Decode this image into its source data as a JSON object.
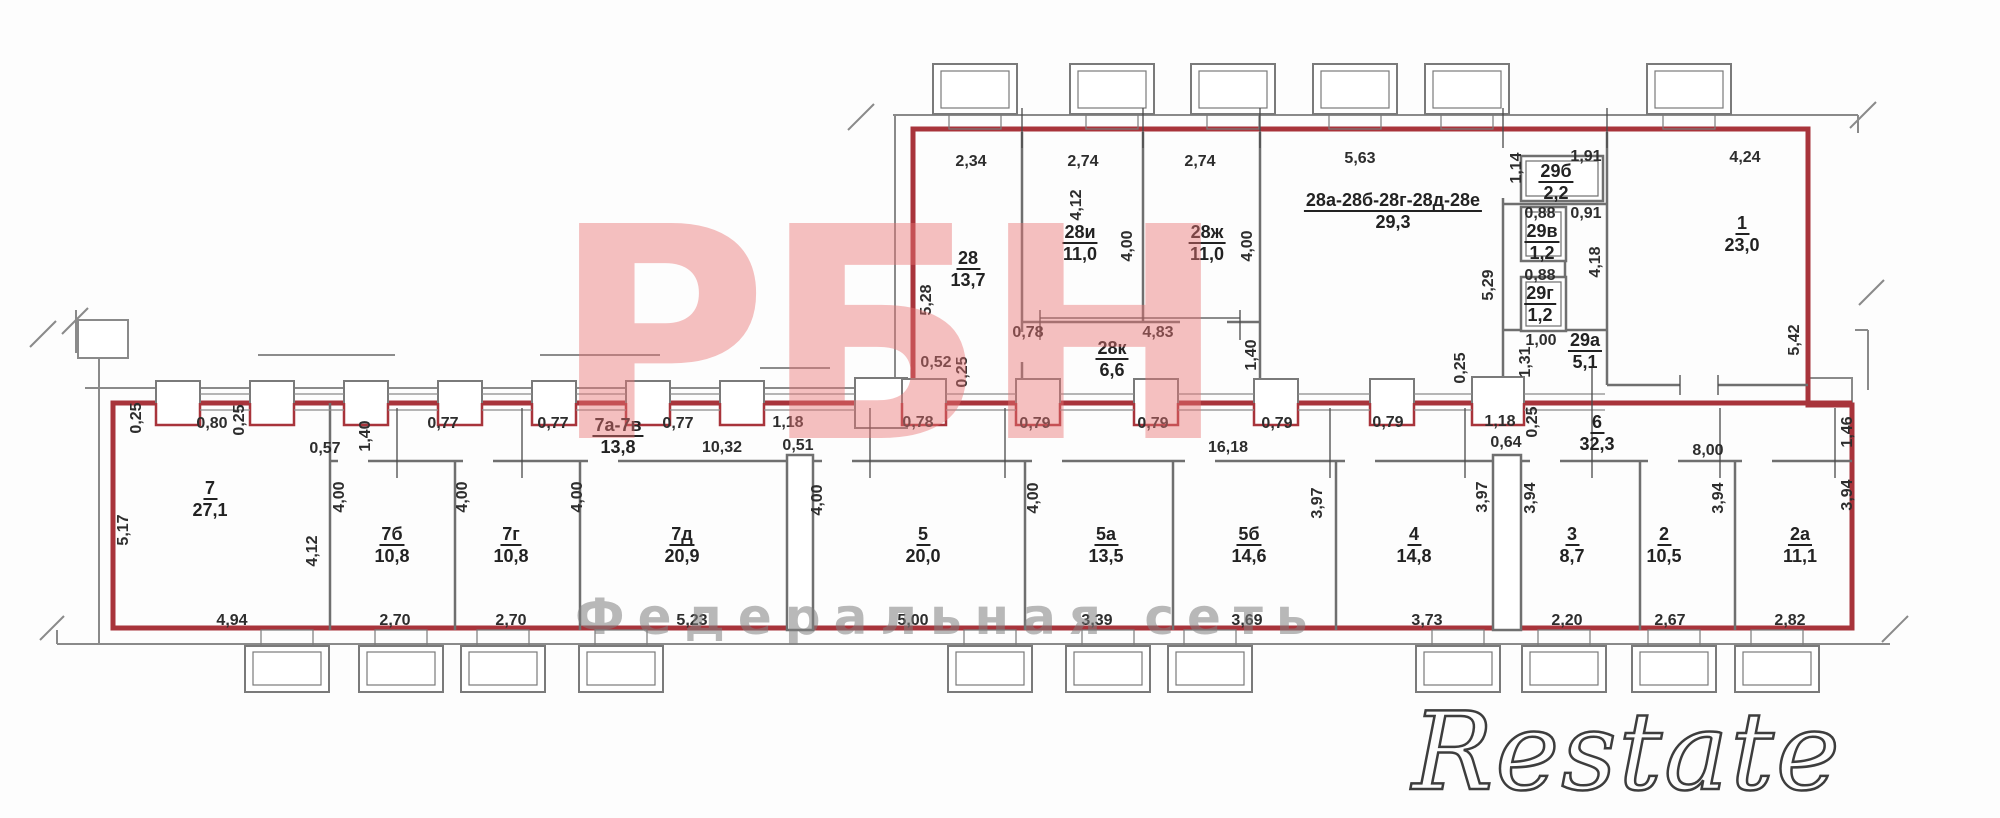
{
  "watermarks": {
    "brand": "РБН",
    "subtitle": "Федеральная сеть",
    "corner": "Restate"
  },
  "colors": {
    "boundary_red": "#A8343B",
    "wall_gray": "#8a8a8a",
    "watermark_pink": "#e97373",
    "watermark_gray": "#808080",
    "text": "#2d2d2d",
    "background": "#ffffff"
  },
  "rooms": [
    {
      "id": "28",
      "area": "13,7",
      "x": 968,
      "y": 248
    },
    {
      "id": "28и",
      "area": "11,0",
      "x": 1080,
      "y": 222
    },
    {
      "id": "28ж",
      "area": "11,0",
      "x": 1207,
      "y": 222
    },
    {
      "id": "28а-28б-28г-28д-28е",
      "area": "29,3",
      "x": 1393,
      "y": 190
    },
    {
      "id": "28к",
      "area": "6,6",
      "x": 1112,
      "y": 338
    },
    {
      "id": "29б",
      "area": "2,2",
      "x": 1556,
      "y": 161
    },
    {
      "id": "29в",
      "area": "1,2",
      "x": 1542,
      "y": 221
    },
    {
      "id": "29г",
      "area": "1,2",
      "x": 1540,
      "y": 283
    },
    {
      "id": "29а",
      "area": "5,1",
      "x": 1585,
      "y": 330
    },
    {
      "id": "1",
      "area": "23,0",
      "x": 1742,
      "y": 213
    },
    {
      "id": "7",
      "area": "27,1",
      "x": 210,
      "y": 478
    },
    {
      "id": "7а-7в",
      "area": "13,8",
      "x": 618,
      "y": 415
    },
    {
      "id": "6",
      "area": "32,3",
      "x": 1597,
      "y": 412
    },
    {
      "id": "7б",
      "area": "10,8",
      "x": 392,
      "y": 524
    },
    {
      "id": "7г",
      "area": "10,8",
      "x": 511,
      "y": 524
    },
    {
      "id": "7д",
      "area": "20,9",
      "x": 682,
      "y": 524
    },
    {
      "id": "5",
      "area": "20,0",
      "x": 923,
      "y": 524
    },
    {
      "id": "5а",
      "area": "13,5",
      "x": 1106,
      "y": 524
    },
    {
      "id": "5б",
      "area": "14,6",
      "x": 1249,
      "y": 524
    },
    {
      "id": "4",
      "area": "14,8",
      "x": 1414,
      "y": 524
    },
    {
      "id": "3",
      "area": "8,7",
      "x": 1572,
      "y": 524
    },
    {
      "id": "2",
      "area": "10,5",
      "x": 1664,
      "y": 524
    },
    {
      "id": "2а",
      "area": "11,1",
      "x": 1800,
      "y": 524
    }
  ],
  "dimensions": [
    {
      "t": "2,34",
      "x": 971,
      "y": 162
    },
    {
      "t": "2,74",
      "x": 1083,
      "y": 162
    },
    {
      "t": "2,74",
      "x": 1200,
      "y": 162
    },
    {
      "t": "5,63",
      "x": 1360,
      "y": 159
    },
    {
      "t": "1,91",
      "x": 1586,
      "y": 157
    },
    {
      "t": "4,24",
      "x": 1745,
      "y": 158
    },
    {
      "t": "1,14",
      "x": 1517,
      "y": 168,
      "r": 1
    },
    {
      "t": "4,12",
      "x": 1077,
      "y": 205,
      "r": 1
    },
    {
      "t": "4,00",
      "x": 1128,
      "y": 246,
      "r": 1
    },
    {
      "t": "4,00",
      "x": 1248,
      "y": 246,
      "r": 1
    },
    {
      "t": "5,28",
      "x": 927,
      "y": 300,
      "r": 1
    },
    {
      "t": "5,29",
      "x": 1489,
      "y": 285,
      "r": 1
    },
    {
      "t": "4,18",
      "x": 1596,
      "y": 262,
      "r": 1
    },
    {
      "t": "5,42",
      "x": 1795,
      "y": 340,
      "r": 1
    },
    {
      "t": "0,88",
      "x": 1540,
      "y": 214
    },
    {
      "t": "0,91",
      "x": 1586,
      "y": 214
    },
    {
      "t": "0,88",
      "x": 1540,
      "y": 276
    },
    {
      "t": "1,00",
      "x": 1541,
      "y": 341
    },
    {
      "t": "1,31",
      "x": 1526,
      "y": 362,
      "r": 1
    },
    {
      "t": "0,52",
      "x": 936,
      "y": 363
    },
    {
      "t": "0,25",
      "x": 963,
      "y": 372,
      "r": 1
    },
    {
      "t": "0,78",
      "x": 1028,
      "y": 333
    },
    {
      "t": "4,83",
      "x": 1158,
      "y": 333
    },
    {
      "t": "1,40",
      "x": 1252,
      "y": 355,
      "r": 1
    },
    {
      "t": "0,25",
      "x": 1461,
      "y": 368,
      "r": 1
    },
    {
      "t": "0,25",
      "x": 137,
      "y": 418,
      "r": 1
    },
    {
      "t": "0,80",
      "x": 212,
      "y": 424
    },
    {
      "t": "0,25",
      "x": 240,
      "y": 420,
      "r": 1
    },
    {
      "t": "0,57",
      "x": 325,
      "y": 449
    },
    {
      "t": "1,40",
      "x": 366,
      "y": 436,
      "r": 1
    },
    {
      "t": "0,77",
      "x": 443,
      "y": 424
    },
    {
      "t": "0,77",
      "x": 553,
      "y": 424
    },
    {
      "t": "0,77",
      "x": 678,
      "y": 424
    },
    {
      "t": "1,18",
      "x": 788,
      "y": 423
    },
    {
      "t": "0,51",
      "x": 798,
      "y": 446
    },
    {
      "t": "10,32",
      "x": 722,
      "y": 448
    },
    {
      "t": "0,78",
      "x": 918,
      "y": 423
    },
    {
      "t": "0,79",
      "x": 1035,
      "y": 424
    },
    {
      "t": "0,79",
      "x": 1153,
      "y": 424
    },
    {
      "t": "0,79",
      "x": 1277,
      "y": 424
    },
    {
      "t": "0,79",
      "x": 1388,
      "y": 423
    },
    {
      "t": "16,18",
      "x": 1228,
      "y": 448
    },
    {
      "t": "1,18",
      "x": 1500,
      "y": 422
    },
    {
      "t": "0,64",
      "x": 1506,
      "y": 443
    },
    {
      "t": "0,25",
      "x": 1533,
      "y": 422,
      "r": 1
    },
    {
      "t": "8,00",
      "x": 1708,
      "y": 451
    },
    {
      "t": "1,46",
      "x": 1848,
      "y": 432,
      "r": 1
    },
    {
      "t": "5,17",
      "x": 124,
      "y": 530,
      "r": 1
    },
    {
      "t": "4,12",
      "x": 313,
      "y": 551,
      "r": 1
    },
    {
      "t": "4,00",
      "x": 340,
      "y": 497,
      "r": 1
    },
    {
      "t": "4,00",
      "x": 463,
      "y": 497,
      "r": 1
    },
    {
      "t": "4,00",
      "x": 578,
      "y": 497,
      "r": 1
    },
    {
      "t": "4,00",
      "x": 818,
      "y": 500,
      "r": 1
    },
    {
      "t": "4,00",
      "x": 1034,
      "y": 498,
      "r": 1
    },
    {
      "t": "3,97",
      "x": 1318,
      "y": 503,
      "r": 1
    },
    {
      "t": "3,97",
      "x": 1483,
      "y": 497,
      "r": 1
    },
    {
      "t": "3,94",
      "x": 1531,
      "y": 498,
      "r": 1
    },
    {
      "t": "3,94",
      "x": 1719,
      "y": 498,
      "r": 1
    },
    {
      "t": "3,94",
      "x": 1848,
      "y": 495,
      "r": 1
    },
    {
      "t": "4,94",
      "x": 232,
      "y": 621
    },
    {
      "t": "2,70",
      "x": 395,
      "y": 621
    },
    {
      "t": "2,70",
      "x": 511,
      "y": 621
    },
    {
      "t": "5,23",
      "x": 692,
      "y": 621
    },
    {
      "t": "5,00",
      "x": 913,
      "y": 621
    },
    {
      "t": "3,39",
      "x": 1097,
      "y": 621
    },
    {
      "t": "3,69",
      "x": 1247,
      "y": 621
    },
    {
      "t": "3,73",
      "x": 1427,
      "y": 621
    },
    {
      "t": "2,20",
      "x": 1567,
      "y": 621
    },
    {
      "t": "2,67",
      "x": 1670,
      "y": 621
    },
    {
      "t": "2,82",
      "x": 1790,
      "y": 621
    }
  ]
}
